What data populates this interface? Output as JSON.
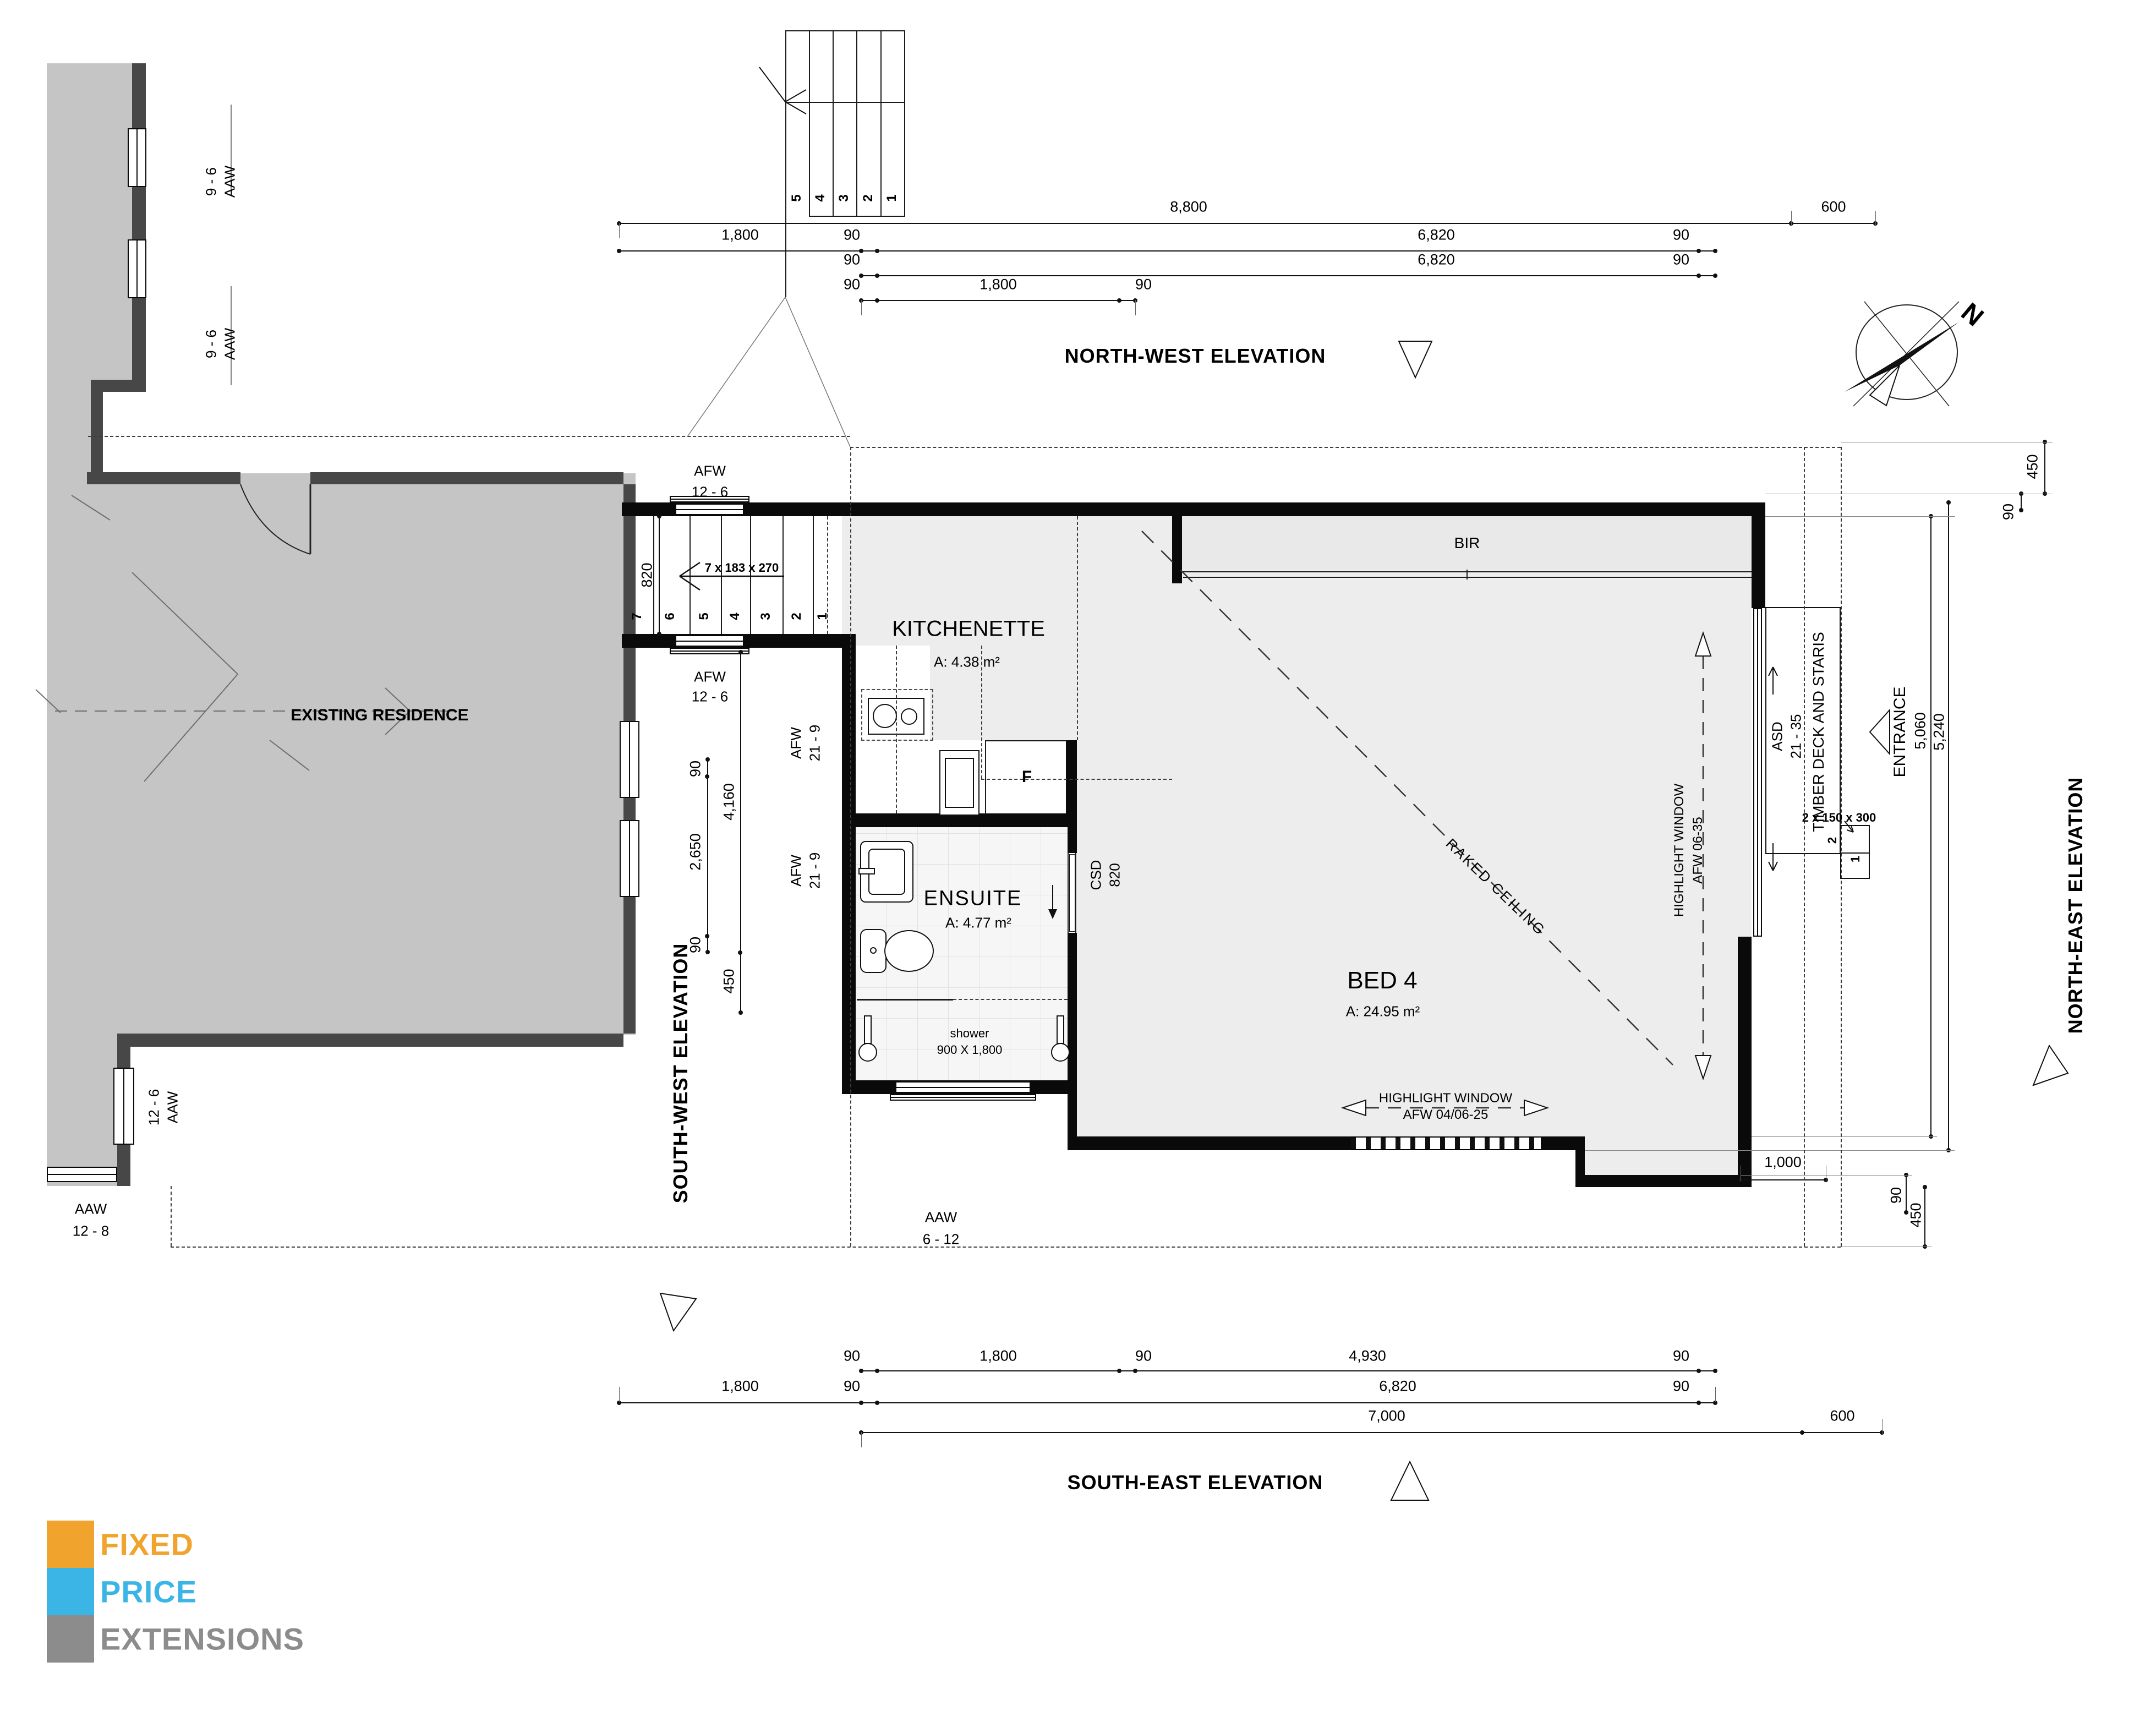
{
  "elevations": {
    "nw": "NORTH-WEST ELEVATION",
    "se": "SOUTH-EAST ELEVATION",
    "sw": "SOUTH-WEST ELEVATION",
    "ne": "NORTH-EAST ELEVATION"
  },
  "compass": {
    "north": "N"
  },
  "rooms": {
    "kitchenette": {
      "name": "KITCHENETTE",
      "area": "A: 4.38 m²"
    },
    "ensuite": {
      "name": "ENSUITE",
      "area": "A: 4.77 m²"
    },
    "bed4": {
      "name": "BED 4",
      "area": "A: 24.95 m²"
    }
  },
  "labels": {
    "existing": "EXISTING RESIDENCE",
    "bir": "BIR",
    "fridge": "F",
    "raked": "RAKED CEILING",
    "shower_l1": "shower",
    "shower_l2": "900 X 1,800",
    "entrance": "ENTRANCE",
    "deck": "TIMBER DECK AND STARIS",
    "aaw96a": {
      "l1": "AAW",
      "l2": "9 - 6"
    },
    "aaw96b": {
      "l1": "AAW",
      "l2": "9 - 6"
    },
    "aaw126": {
      "l1": "AAW",
      "l2": "12 - 6"
    },
    "aaw128": {
      "l1": "AAW",
      "l2": "12 - 8"
    },
    "afw126top": {
      "l1": "AFW",
      "l2": "12 - 6"
    },
    "afw126bot": {
      "l1": "AFW",
      "l2": "12 - 6"
    },
    "afw219a": {
      "l1": "AFW",
      "l2": "21 - 9"
    },
    "afw219b": {
      "l1": "AFW",
      "l2": "21 - 9"
    },
    "aaw612": {
      "l1": "AAW",
      "l2": "6 - 12"
    },
    "csd": {
      "l1": "CSD",
      "l2": "820"
    },
    "asd": {
      "l1": "ASD",
      "l2": "21 - 35"
    },
    "hlRight": {
      "l1": "HIGHLIGHT WINDOW",
      "l2": "AFW 06-35"
    },
    "hlBottom": {
      "l1": "HIGHLIGHT WINDOW",
      "l2": "AFW 04/06-25"
    }
  },
  "stairs": {
    "spec": "7 x 183 x 270",
    "plan_numbers": [
      "7",
      "6",
      "5",
      "4",
      "3",
      "2",
      "1"
    ],
    "detail_numbers": [
      "5",
      "4",
      "3",
      "2",
      "1"
    ],
    "lobby_width": "820",
    "deck_steps": "2 x 150 x 300",
    "deck_step_numbers": [
      "2",
      "1"
    ]
  },
  "dims": {
    "top1_a": "8,800",
    "top1_b": "600",
    "top2_a": "1,800",
    "top2_b": "90",
    "top2_c": "6,820",
    "top2_d": "90",
    "top3_a": "90",
    "top3_b": "6,820",
    "top3_c": "90",
    "top4_a": "90",
    "top4_b": "1,800",
    "top4_c": "90",
    "tr_450": "450",
    "tr_90": "90",
    "left_820": "820",
    "left_90a": "90",
    "left_2650": "2,650",
    "left_90b": "90",
    "left_4160": "4,160",
    "left_450": "450",
    "right_5060": "5,060",
    "right_5240": "5,240",
    "br_1000": "1,000",
    "br_90": "90",
    "br_450": "450",
    "bot1_a": "90",
    "bot1_b": "1,800",
    "bot1_c": "90",
    "bot1_d": "4,930",
    "bot1_e": "90",
    "bot2_a": "1,800",
    "bot2_b": "90",
    "bot2_c": "6,820",
    "bot2_d": "90",
    "bot3_a": "7,000",
    "bot3_b": "600"
  },
  "logo": {
    "fixed": {
      "text": "FIXED",
      "color": "#F0A42E"
    },
    "price": {
      "text": "PRICE",
      "color": "#3AB5E6"
    },
    "extensions": {
      "text": "EXTENSIONS",
      "color": "#8C8C8C"
    }
  }
}
